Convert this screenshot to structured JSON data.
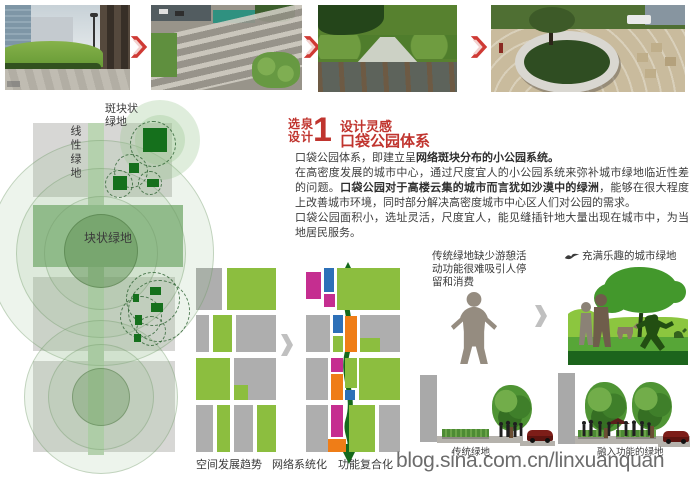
{
  "board": {
    "watermark": "blog.sina.com.cn/linxuanquan"
  },
  "colors": {
    "accent_red": "#c0342e",
    "apple_green": "#8cbe3f",
    "magenta": "#c52e90",
    "blue": "#2d70b8",
    "orange": "#ef7d17",
    "arrow_green": "#15691b",
    "sage_green": "#93bd8d",
    "patch_green": "#15701c"
  },
  "left_diagram": {
    "patch_label_lines": [
      "斑块状",
      "绿地"
    ],
    "linear_label": "线性绿地",
    "block_label": "块状绿地",
    "blocks": [
      {
        "x": 88,
        "y": 23,
        "w": 16,
        "h": 332,
        "c": "strip",
        "n": "linear-green-strip"
      },
      {
        "x": 33,
        "y": 23,
        "w": 55,
        "h": 74,
        "c": "lgray",
        "n": "city-block"
      },
      {
        "x": 104,
        "y": 23,
        "w": 68,
        "h": 74,
        "c": "lgray",
        "n": "city-block"
      },
      {
        "x": 33,
        "y": 105,
        "w": 150,
        "h": 62,
        "c": "rowgreen",
        "n": "block-green-park"
      },
      {
        "x": 33,
        "y": 177,
        "w": 55,
        "h": 74,
        "c": "lgray",
        "n": "city-block"
      },
      {
        "x": 104,
        "y": 177,
        "w": 71,
        "h": 74,
        "c": "lgray",
        "n": "city-block"
      },
      {
        "x": 33,
        "y": 261,
        "w": 55,
        "h": 91,
        "c": "lgray",
        "n": "city-block"
      },
      {
        "x": 104,
        "y": 261,
        "w": 71,
        "h": 91,
        "c": "lgray",
        "n": "city-block"
      }
    ],
    "circles": [
      {
        "cx": 100,
        "cy": 152,
        "r": 112,
        "s": "glow"
      },
      {
        "cx": 100,
        "cy": 152,
        "r": 84,
        "s": "glow"
      },
      {
        "cx": 100,
        "cy": 152,
        "r": 56,
        "s": "glow"
      },
      {
        "cx": 100,
        "cy": 150,
        "r": 36,
        "s": "inner"
      },
      {
        "cx": 100,
        "cy": 296,
        "r": 76,
        "s": "glow"
      },
      {
        "cx": 100,
        "cy": 296,
        "r": 52,
        "s": "glow"
      },
      {
        "cx": 100,
        "cy": 296,
        "r": 28,
        "s": "inner2"
      },
      {
        "cx": 160,
        "cy": 40,
        "r": 40,
        "s": "halo"
      },
      {
        "cx": 160,
        "cy": 40,
        "r": 25,
        "s": "halo"
      },
      {
        "cx": 152,
        "cy": 43,
        "r": 22,
        "s": "dash"
      },
      {
        "cx": 130,
        "cy": 70,
        "r": 16,
        "s": "dash"
      },
      {
        "cx": 118,
        "cy": 83,
        "r": 13,
        "s": "dash"
      },
      {
        "cx": 149,
        "cy": 82,
        "r": 11,
        "s": "dash"
      },
      {
        "cx": 152,
        "cy": 198,
        "r": 26,
        "s": "dash"
      },
      {
        "cx": 140,
        "cy": 216,
        "r": 20,
        "s": "dash"
      },
      {
        "cx": 150,
        "cy": 230,
        "r": 14,
        "s": "dash"
      },
      {
        "cx": 158,
        "cy": 210,
        "r": 30,
        "s": "dash"
      }
    ],
    "patches": [
      {
        "x": 143,
        "y": 28,
        "w": 24,
        "h": 24
      },
      {
        "x": 129,
        "y": 63,
        "w": 10,
        "h": 10
      },
      {
        "x": 113,
        "y": 76,
        "w": 14,
        "h": 14
      },
      {
        "x": 147,
        "y": 79,
        "w": 12,
        "h": 8
      },
      {
        "x": 150,
        "y": 187,
        "w": 11,
        "h": 8
      },
      {
        "x": 133,
        "y": 194,
        "w": 6,
        "h": 8
      },
      {
        "x": 151,
        "y": 203,
        "w": 12,
        "h": 9
      },
      {
        "x": 135,
        "y": 215,
        "w": 7,
        "h": 10
      },
      {
        "x": 134,
        "y": 234,
        "w": 7,
        "h": 8
      }
    ]
  },
  "inspiration": {
    "stamp_lines": [
      "选泉",
      "设计"
    ],
    "number": "1",
    "subtitle": "设计灵感",
    "title": "口袋公园体系",
    "paragraphs": [
      [
        {
          "t": "口袋公园体系，即建立呈"
        },
        {
          "t": "网络斑块分布的小公园系统。",
          "b": true
        }
      ],
      [
        {
          "t": "在高密度发展的城市中心，通过尺度宜人的小公园系统来弥补城市绿地临近性差的问题。"
        },
        {
          "t": "口袋公园对于高楼云集的城市而言犹如沙漠中的绿洲",
          "b": true
        },
        {
          "t": "，能够在很大程度上改善城市环境，同时部分解决高密度城市中心区人们对公园的需求。"
        }
      ],
      [
        {
          "t": "口袋公园面积小，选址灵活，尺度宜人，能见缝插针地大量出现在城市中，为当地居民服务。"
        }
      ]
    ]
  },
  "evolution": {
    "labels": [
      "空间发展趋势",
      "网络系统化",
      "功能复合化"
    ],
    "left_blocks": [
      {
        "x": 6,
        "y": 8,
        "w": 26,
        "h": 42,
        "c": "gray"
      },
      {
        "x": 37,
        "y": 8,
        "w": 49,
        "h": 42,
        "c": "green"
      },
      {
        "x": 6,
        "y": 55,
        "w": 13,
        "h": 37,
        "c": "gray"
      },
      {
        "x": 23,
        "y": 55,
        "w": 19,
        "h": 37,
        "c": "green"
      },
      {
        "x": 46,
        "y": 55,
        "w": 40,
        "h": 37,
        "c": "gray"
      },
      {
        "x": 6,
        "y": 98,
        "w": 34,
        "h": 42,
        "c": "green"
      },
      {
        "x": 44,
        "y": 98,
        "w": 42,
        "h": 42,
        "c": "gray"
      },
      {
        "x": 44,
        "y": 125,
        "w": 14,
        "h": 15,
        "c": "green"
      },
      {
        "x": 6,
        "y": 145,
        "w": 17,
        "h": 47,
        "c": "gray"
      },
      {
        "x": 27,
        "y": 145,
        "w": 13,
        "h": 47,
        "c": "green"
      },
      {
        "x": 44,
        "y": 145,
        "w": 19,
        "h": 47,
        "c": "gray"
      },
      {
        "x": 67,
        "y": 145,
        "w": 19,
        "h": 47,
        "c": "green"
      }
    ],
    "right_blocks": [
      {
        "x": 116,
        "y": 12,
        "w": 15,
        "h": 27,
        "c": "magenta"
      },
      {
        "x": 134,
        "y": 8,
        "w": 10,
        "h": 24,
        "c": "blue"
      },
      {
        "x": 134,
        "y": 34,
        "w": 11,
        "h": 13,
        "c": "magenta"
      },
      {
        "x": 147,
        "y": 8,
        "w": 63,
        "h": 42,
        "c": "green"
      },
      {
        "x": 116,
        "y": 55,
        "w": 24,
        "h": 37,
        "c": "gray"
      },
      {
        "x": 143,
        "y": 55,
        "w": 10,
        "h": 18,
        "c": "blue"
      },
      {
        "x": 155,
        "y": 56,
        "w": 12,
        "h": 36,
        "c": "orange"
      },
      {
        "x": 143,
        "y": 76,
        "w": 10,
        "h": 16,
        "c": "green"
      },
      {
        "x": 170,
        "y": 55,
        "w": 40,
        "h": 37,
        "c": "gray"
      },
      {
        "x": 170,
        "y": 78,
        "w": 20,
        "h": 14,
        "c": "green"
      },
      {
        "x": 116,
        "y": 98,
        "w": 22,
        "h": 42,
        "c": "gray"
      },
      {
        "x": 141,
        "y": 98,
        "w": 12,
        "h": 14,
        "c": "magenta"
      },
      {
        "x": 141,
        "y": 114,
        "w": 12,
        "h": 26,
        "c": "orange"
      },
      {
        "x": 155,
        "y": 98,
        "w": 12,
        "h": 30,
        "c": "green"
      },
      {
        "x": 155,
        "y": 130,
        "w": 10,
        "h": 10,
        "c": "blue"
      },
      {
        "x": 169,
        "y": 98,
        "w": 41,
        "h": 42,
        "c": "green"
      },
      {
        "x": 116,
        "y": 145,
        "w": 22,
        "h": 47,
        "c": "gray"
      },
      {
        "x": 141,
        "y": 145,
        "w": 12,
        "h": 32,
        "c": "magenta"
      },
      {
        "x": 138,
        "y": 179,
        "w": 18,
        "h": 13,
        "c": "orange"
      },
      {
        "x": 159,
        "y": 145,
        "w": 26,
        "h": 47,
        "c": "green"
      },
      {
        "x": 189,
        "y": 145,
        "w": 21,
        "h": 47,
        "c": "gray"
      }
    ]
  },
  "comparison": {
    "problem_lines": [
      "传统绿地缺少游憩活",
      "动功能很难吸引人停",
      "留和消费"
    ],
    "solution_label": "充满乐趣的城市绿地"
  },
  "sections": {
    "left_label": "传统绿地",
    "right_label": "融入功能的绿地"
  }
}
